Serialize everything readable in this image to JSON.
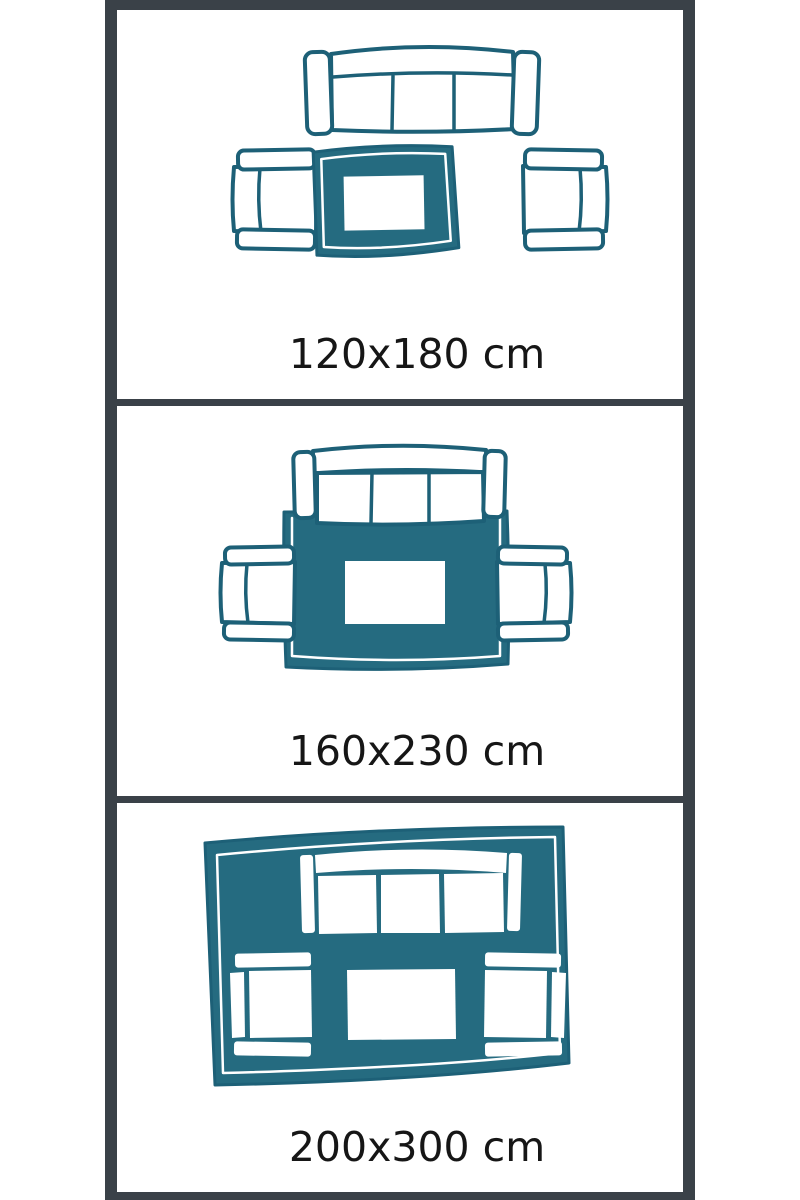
{
  "colors": {
    "illustration_teal": "#256b80",
    "illustration_teal_outline": "#1d6077",
    "frame_dark": "#3a4148",
    "panel_background": "#ffffff",
    "page_background": "#ffffff",
    "label_text": "#161616"
  },
  "panels": [
    {
      "id": "rug-size-120x180",
      "label": "120x180 cm",
      "width_cm": 120,
      "length_cm": 180,
      "elements": [
        "sofa-top-view",
        "armchair-left",
        "armchair-right",
        "rug",
        "coffee-table"
      ]
    },
    {
      "id": "rug-size-160x230",
      "label": "160x230 cm",
      "width_cm": 160,
      "length_cm": 230,
      "elements": [
        "sofa-top-view",
        "armchair-left",
        "armchair-right",
        "rug",
        "coffee-table"
      ]
    },
    {
      "id": "rug-size-200x300",
      "label": "200x300 cm",
      "width_cm": 200,
      "length_cm": 300,
      "elements": [
        "sofa-top-view",
        "armchair-left",
        "armchair-right",
        "rug",
        "coffee-table"
      ]
    }
  ]
}
